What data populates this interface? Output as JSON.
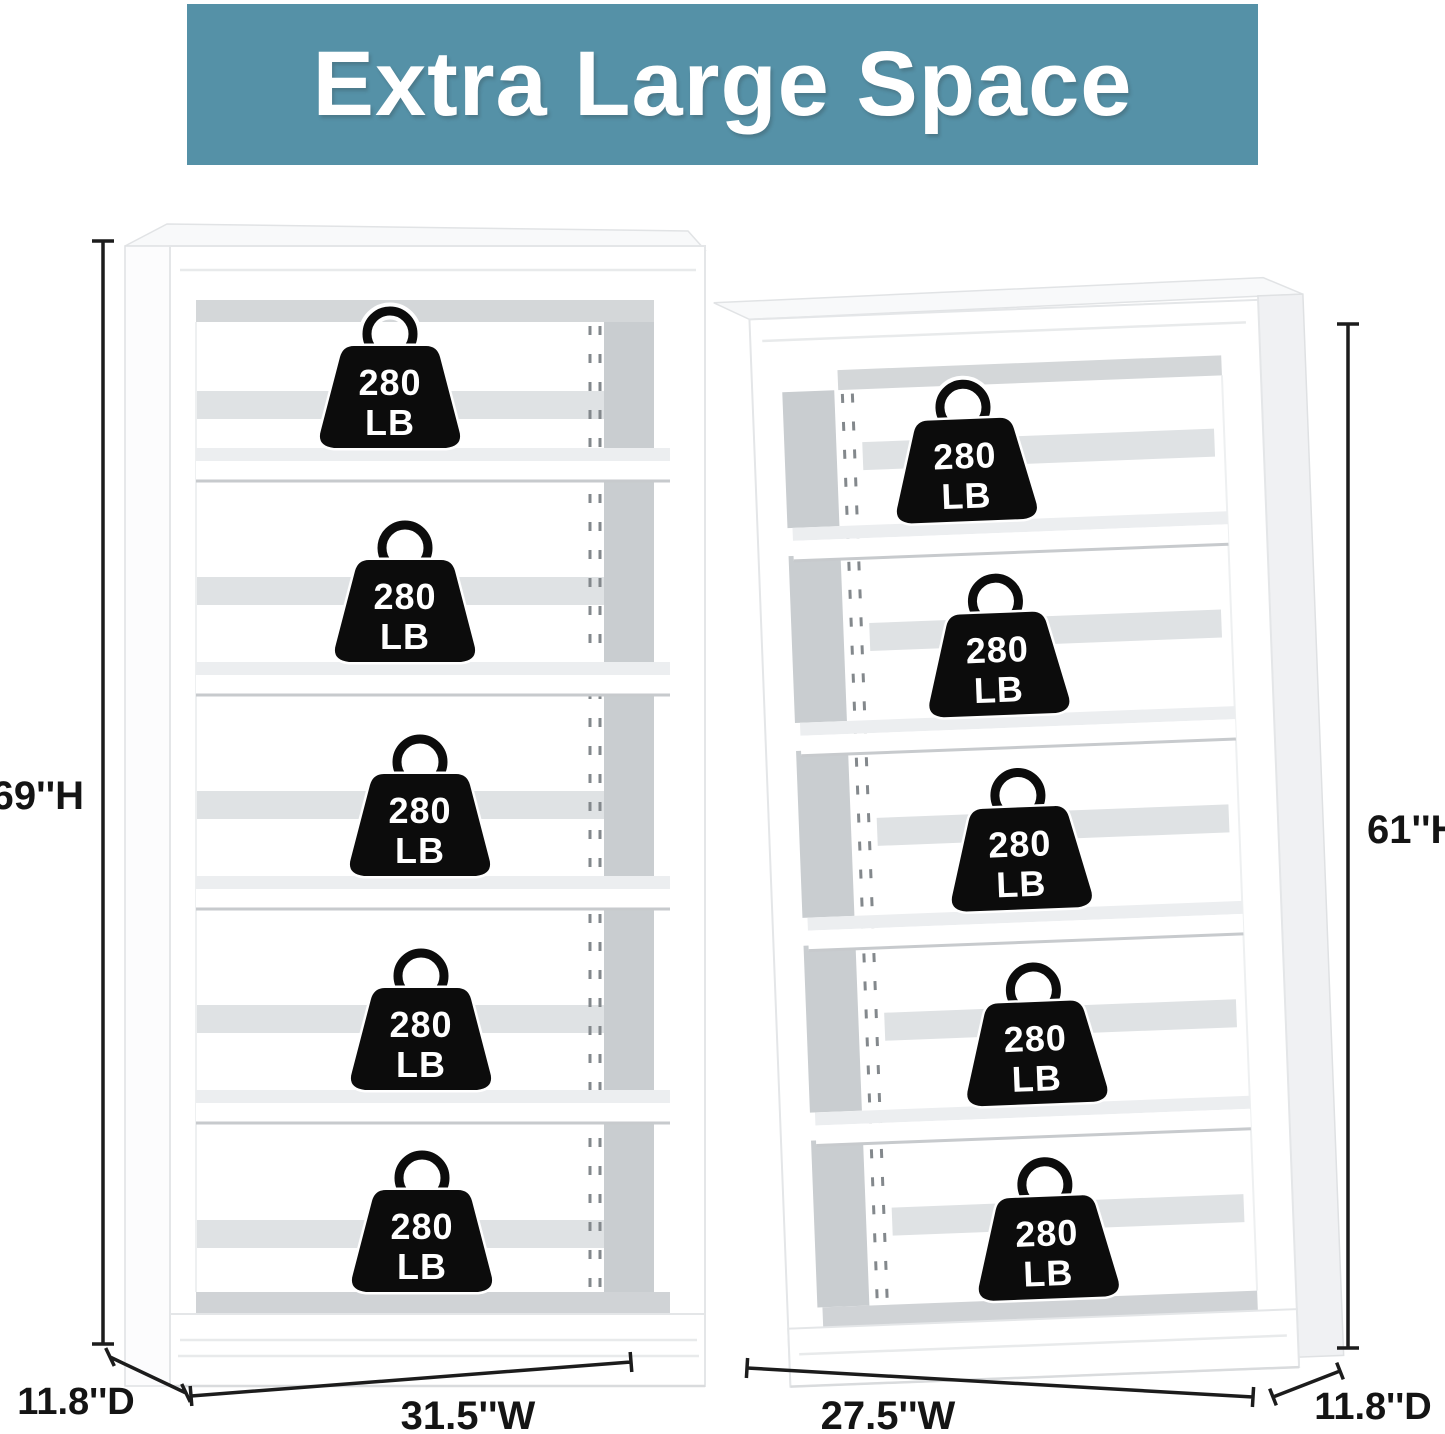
{
  "banner": {
    "title": "Extra Large Space"
  },
  "weight_badge": {
    "line1": "280",
    "line2": "LB",
    "full_label": "280 LB"
  },
  "units": {
    "left": {
      "shelf_count": 5,
      "height_label": "69''H",
      "width_label": "31.5''W",
      "depth_label": "11.8''D"
    },
    "right": {
      "shelf_count": 5,
      "height_label": "61''H",
      "width_label": "27.5''W",
      "depth_label": "11.8''D"
    }
  },
  "colors": {
    "banner_bg": "#5591a7",
    "banner_text": "#ffffff",
    "weight_badge_bg": "#0c0c0c",
    "weight_badge_text": "#ffffff",
    "dimension_line": "#1c1c1c",
    "shelf_interior_gray": "#c9cdd0"
  }
}
